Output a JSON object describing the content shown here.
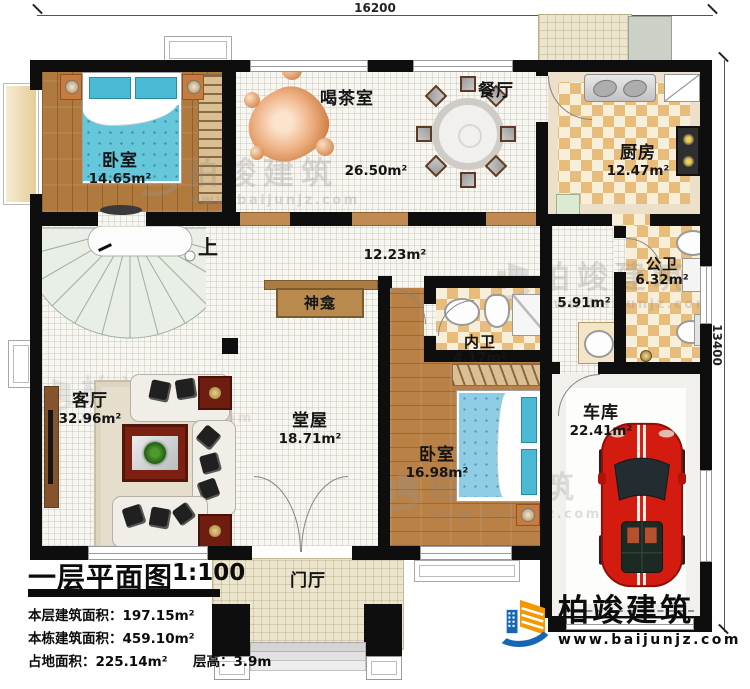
{
  "dimensions": {
    "width_label": "16200",
    "height_label": "13400"
  },
  "rooms": {
    "bedroom1": {
      "name": "卧室",
      "area": "14.65m²"
    },
    "tea_room": {
      "name": "喝茶室",
      "area": "26.50m²"
    },
    "dining": {
      "name": "餐厅"
    },
    "kitchen": {
      "name": "厨房",
      "area": "12.47m²"
    },
    "hall": {
      "area": "12.23m²"
    },
    "public_bath": {
      "name": "公卫",
      "area": "6.32m²"
    },
    "utility": {
      "area": "5.91m²"
    },
    "inner_bath": {
      "name": "内卫",
      "area": "4.17m²"
    },
    "bedroom2": {
      "name": "卧室",
      "area": "16.98m²"
    },
    "garage": {
      "name": "车库",
      "area": "22.41m²"
    },
    "living_room": {
      "name": "客厅",
      "area": "32.96m²"
    },
    "main_hall": {
      "name": "堂屋",
      "area": "18.71m²"
    },
    "entry_hall": {
      "name": "门厅"
    },
    "shrine": {
      "name": "神龛"
    },
    "stairs": {
      "up_label": "上"
    }
  },
  "title_block": {
    "title": "一层平面图",
    "scale": "1:100",
    "floor_area_label": "本层建筑面积：",
    "floor_area_value": "197.15m²",
    "total_area_label": "本栋建筑面积：",
    "total_area_value": "459.10m²",
    "land_area_label": "占地面积：",
    "land_area_value": "225.14m²",
    "storey_height_label": "层高：",
    "storey_height_value": "3.9m"
  },
  "branding": {
    "company": "柏竣建筑",
    "website": "www.baijunjz.com"
  },
  "watermark": {
    "company": "柏竣建筑",
    "website": "www.baijunjz.com"
  },
  "colors": {
    "wall": "#0e0e0e",
    "wood_floor": "#b0793e",
    "checker_tan": "#e8bd7c",
    "bed_blue": "#5fc4d8",
    "car_red": "#cf1711",
    "logo_blue": "#1567b3",
    "logo_orange": "#f39800"
  }
}
